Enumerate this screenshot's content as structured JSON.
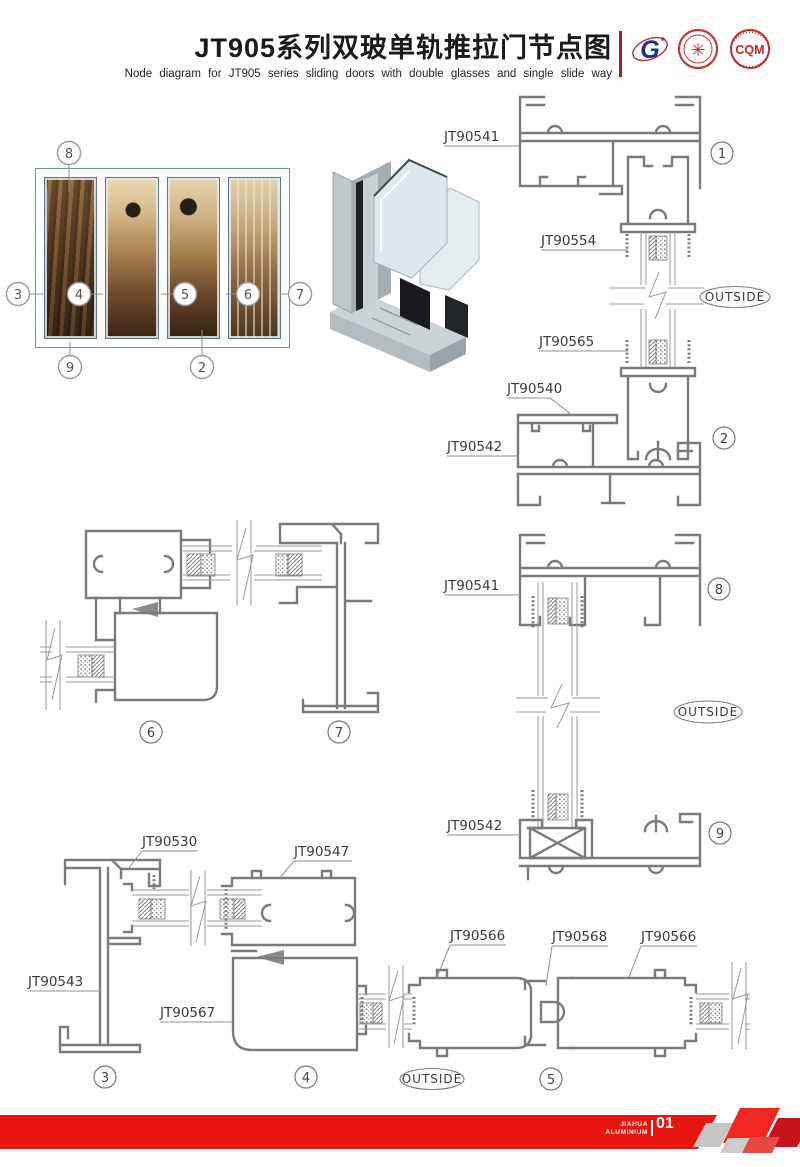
{
  "colors": {
    "accent_red": "#e8150f",
    "line_gray": "#7b7b7b",
    "frame_silver": "#a9bcc6",
    "label_text": "#3a3a3a"
  },
  "header": {
    "title_cn": "JT905系列双玻单轨推拉门节点图",
    "title_en": "Node diagram for JT905 series sliding doors with double glasses and single slide way",
    "logos": {
      "g_letter": "G",
      "cert_glyph": "✳",
      "cqm": "CQM"
    }
  },
  "photo": {
    "callouts": {
      "c2": "2",
      "c3": "3",
      "c4": "4",
      "c5": "5",
      "c6": "6",
      "c7": "7",
      "c8": "8",
      "c9": "9"
    }
  },
  "drawings": {
    "outside": "OUTSIDE",
    "node12": {
      "jt90541": "JT90541",
      "jt90554": "JT90554",
      "jt90565": "JT90565",
      "jt90540": "JT90540",
      "jt90542": "JT90542",
      "badge1": "1",
      "badge2": "2"
    },
    "node67": {
      "badge6": "6",
      "badge7": "7"
    },
    "node89": {
      "jt90541": "JT90541",
      "jt90542": "JT90542",
      "badge8": "8",
      "badge9": "9"
    },
    "node34": {
      "jt90530": "JT90530",
      "jt90547": "JT90547",
      "jt90543": "JT90543",
      "jt90567": "JT90567",
      "badge3": "3",
      "badge4": "4"
    },
    "node5": {
      "jt90566_left": "JT90566",
      "jt90568": "JT90568",
      "jt90566_right": "JT90566",
      "badge5": "5"
    }
  },
  "footer": {
    "brand_line1": "JIAHUA",
    "brand_line2": "ALUMINIUM",
    "page_number": "01"
  }
}
